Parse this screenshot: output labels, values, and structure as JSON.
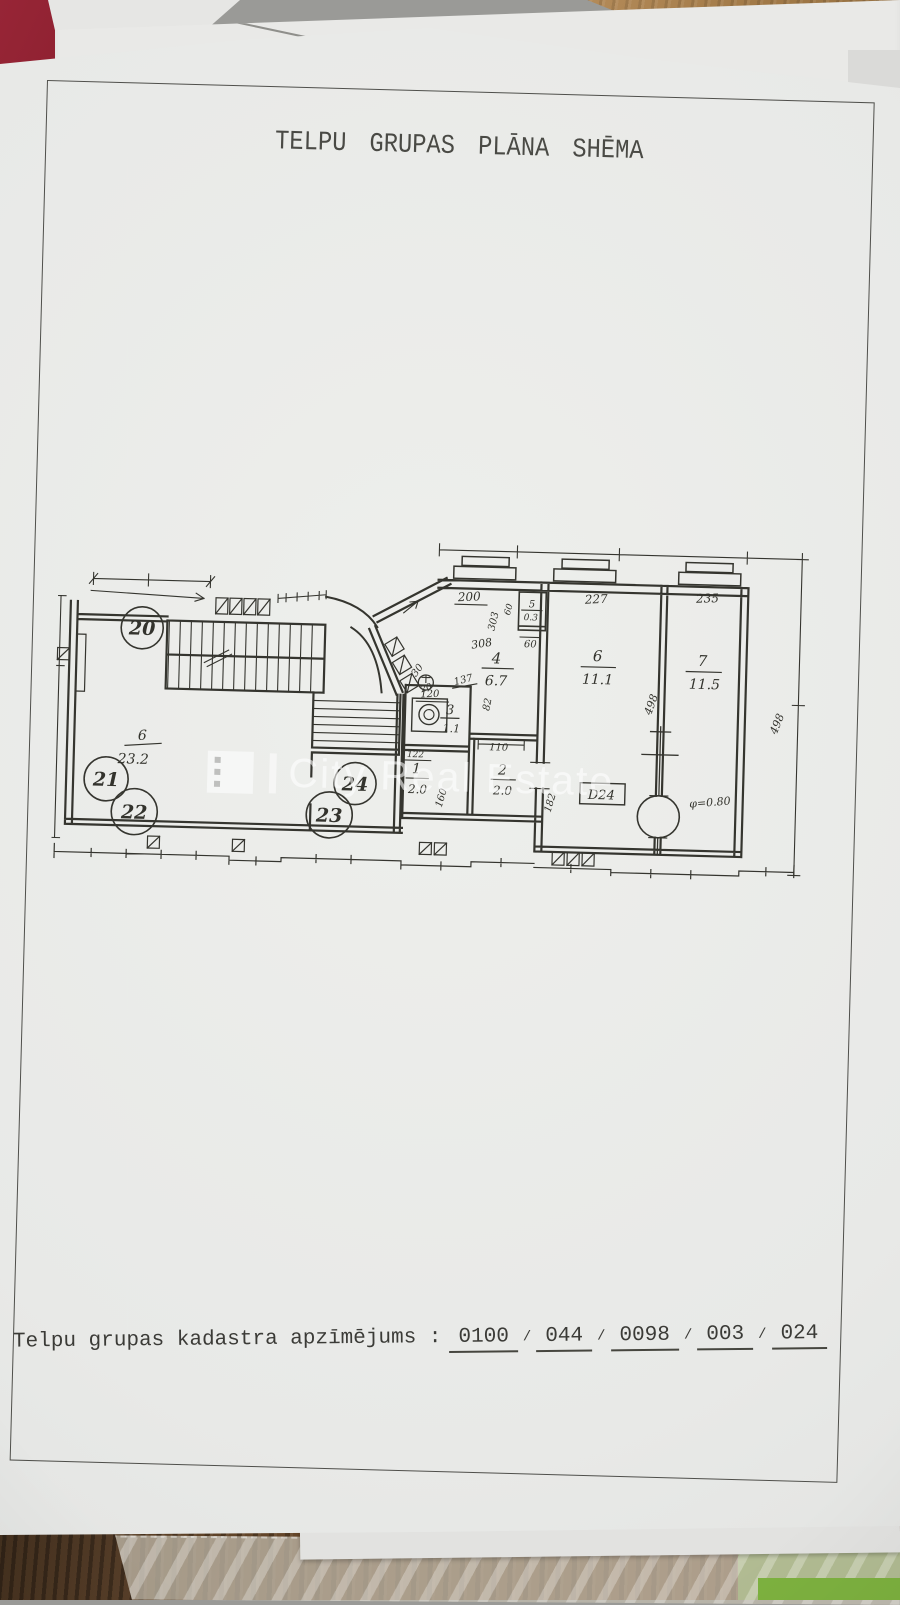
{
  "document": {
    "title": "TELPU GRUPAS PLĀNA SHĒMA",
    "cadastre_label": "Telpu grupas kadastra apzīmējums :",
    "cadastre_parts": [
      "0100",
      "044",
      "0098",
      "003",
      "024"
    ],
    "cadastre_separator": "/"
  },
  "watermark": {
    "text": "City Real Estate"
  },
  "plan": {
    "rooms": {
      "r1": {
        "num": "1",
        "area": "2.0"
      },
      "r2": {
        "num": "2",
        "area": "2.0"
      },
      "r3": {
        "num": "3",
        "area": "1.1"
      },
      "r4": {
        "num": "4",
        "area": "6.7"
      },
      "r5": {
        "num": "5",
        "area": "0.3"
      },
      "r6": {
        "num": "6",
        "area": "11.1"
      },
      "r7": {
        "num": "7",
        "area": "11.5"
      },
      "stairhall": {
        "num": "6",
        "area": "23.2"
      }
    },
    "circled": {
      "c20": "20",
      "c21": "21",
      "c22": "22",
      "c23": "23",
      "c24": "24"
    },
    "dims": {
      "d200": "200",
      "d303": "303",
      "d60a": "60",
      "d60b": "60",
      "d308": "308",
      "d227": "227",
      "d235": "235",
      "d498a": "498",
      "d498b": "498",
      "d120": "120",
      "d137": "137",
      "d82": "82",
      "d122": "122",
      "d110": "110",
      "d160": "160",
      "d182": "182",
      "d30": "30",
      "d20": "20"
    },
    "labels": {
      "door": "D24",
      "column_diameter": "φ=0.80"
    }
  },
  "colors": {
    "paper": "#e9eae8",
    "ink": "#35352f",
    "wood": "#8d6a3d",
    "green_object": "#82b446"
  }
}
